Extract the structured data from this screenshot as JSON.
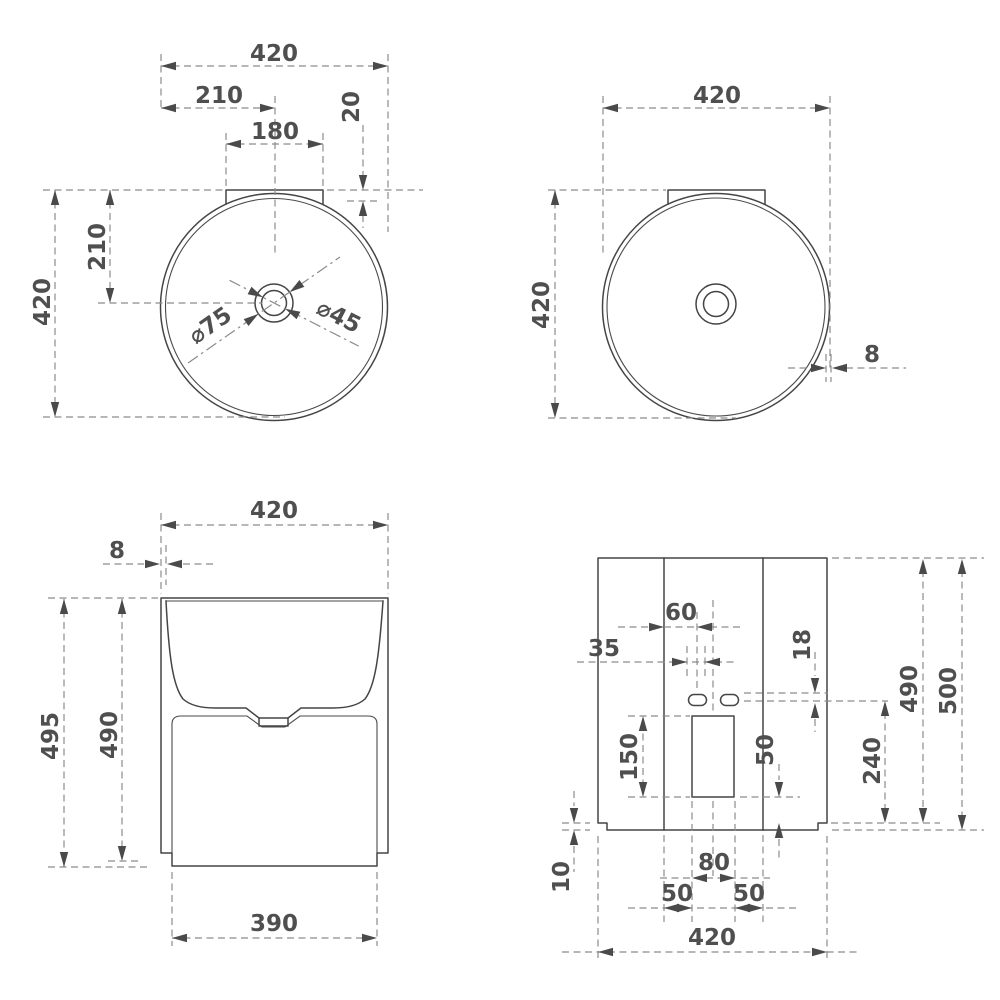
{
  "drawing": {
    "kind": "technical-dimension-drawing",
    "subject": "wall-hung pedestal washbasin, four orthographic views",
    "units": "mm",
    "line_color": "#454545",
    "dim_color": "#8c8c8c",
    "text_color": "#4f4f4f",
    "views": {
      "plan": {
        "label": "plan view with fitting dimensions",
        "dims": {
          "overall_width": "420",
          "center_offset": "210",
          "flange_width": "180",
          "flange_depth": "20",
          "depth_to_center": "210",
          "overall_depth": "420",
          "drain_diameter": "⌀75",
          "faucet_hole_diameter": "⌀45"
        }
      },
      "plan_plain": {
        "label": "plan view with rim thickness",
        "dims": {
          "overall_width": "420",
          "overall_depth": "420",
          "rim_thickness": "8"
        }
      },
      "front": {
        "label": "front elevation",
        "dims": {
          "overall_width": "420",
          "wall_thickness": "8",
          "overall_height": "495",
          "body_height": "490",
          "base_width": "390"
        }
      },
      "rear": {
        "label": "rear elevation with mounting holes",
        "dims": {
          "hole_center_offset": "60",
          "hole_slot_length": "35",
          "hole_slot_height": "18",
          "body_height": "490",
          "overall_height": "500",
          "opening_height": "150",
          "opening_to_base": "50",
          "holes_to_base": "240",
          "plinth_recess": "10",
          "opening_width": "80",
          "seam_gap_left": "50",
          "seam_gap_right": "50",
          "overall_width": "420"
        }
      }
    }
  }
}
